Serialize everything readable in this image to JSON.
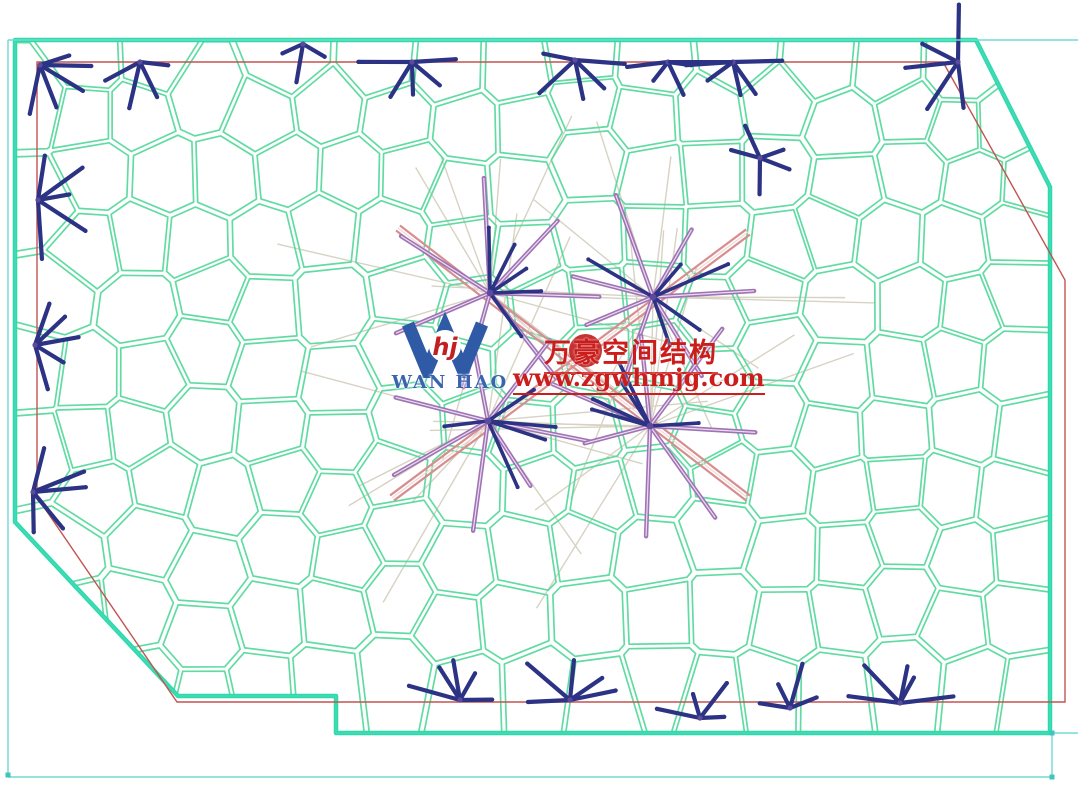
{
  "watermark": {
    "company_cn": "万豪空间结构",
    "url": "www.zgwhmjg.com",
    "logo_text": "WAN HAO",
    "logo_monogram": "hj"
  },
  "diagram": {
    "colors": {
      "background": "#ffffff",
      "mesh_line": "#55d89b",
      "border_green": "#2bdda3",
      "border_teal": "#46d6c4",
      "red": "#c25450",
      "cyan": "#73d8d2",
      "cyan_dot": "#3fc4be",
      "navy": "#2c3384",
      "node_purple": "#5d4a9c",
      "purple": "#a073b4",
      "purple_core": "#eadcf2",
      "pink": "#d88e8e",
      "pink_core": "#f2d8d8",
      "beige": "#d7d2c3",
      "logo_blue": "#2f5ba6",
      "logo_text_blue": "#3a64b0",
      "red_text": "#cc1d1d",
      "seal_red": "#c22020"
    },
    "outline": [
      [
        15,
        40
      ],
      [
        976,
        40
      ],
      [
        1050,
        187
      ],
      [
        1050,
        733
      ],
      [
        336,
        733
      ],
      [
        336,
        696
      ],
      [
        178,
        696
      ],
      [
        15,
        522
      ]
    ],
    "red_outline": [
      [
        37,
        62
      ],
      [
        943,
        62
      ],
      [
        1065,
        280
      ],
      [
        1065,
        702
      ],
      [
        177,
        702
      ],
      [
        37,
        497
      ]
    ],
    "cyan_segments": [
      [
        8,
        40,
        1078,
        40
      ],
      [
        8,
        40,
        8,
        775
      ],
      [
        8,
        777,
        1052,
        777
      ],
      [
        1052,
        733,
        1052,
        777
      ],
      [
        1050,
        733,
        1078,
        733
      ]
    ],
    "cyan_dots": [
      [
        8,
        775
      ],
      [
        1052,
        777
      ],
      [
        1052,
        733
      ]
    ],
    "mesh": {
      "seed": 7,
      "clip": [
        [
          12,
          38
        ],
        [
          978,
          38
        ],
        [
          1052,
          188
        ],
        [
          1052,
          736
        ],
        [
          12,
          736
        ]
      ],
      "x0": 20,
      "x1": 1055,
      "y0": 48,
      "y1": 740,
      "step": 63,
      "jitter": 20,
      "lloyd": 2,
      "inset": 0.93,
      "strokeW": 1.7
    },
    "stars": [
      [
        40,
        65,
        5,
        -25,
        105,
        28,
        55
      ],
      [
        140,
        62,
        4,
        15,
        165,
        25,
        48
      ],
      [
        303,
        44,
        3,
        30,
        150,
        22,
        40
      ],
      [
        412,
        62,
        5,
        5,
        175,
        28,
        55
      ],
      [
        575,
        60,
        5,
        0,
        180,
        30,
        60
      ],
      [
        668,
        62,
        4,
        15,
        165,
        22,
        42
      ],
      [
        733,
        62,
        5,
        0,
        180,
        28,
        52
      ],
      [
        958,
        62,
        5,
        78,
        258,
        35,
        62
      ],
      [
        38,
        200,
        5,
        -78,
        78,
        30,
        60
      ],
      [
        35,
        345,
        5,
        -78,
        78,
        30,
        60
      ],
      [
        33,
        492,
        5,
        -70,
        80,
        28,
        55
      ],
      [
        460,
        700,
        5,
        188,
        352,
        30,
        55
      ],
      [
        570,
        700,
        5,
        185,
        355,
        30,
        58
      ],
      [
        700,
        718,
        4,
        192,
        348,
        24,
        45
      ],
      [
        790,
        708,
        4,
        190,
        350,
        25,
        50
      ],
      [
        900,
        703,
        5,
        186,
        354,
        28,
        55
      ],
      [
        760,
        158,
        5,
        0,
        360,
        22,
        42
      ]
    ],
    "navy_chords": [
      [
        670,
        62,
        731,
        62
      ]
    ],
    "hubs": [
      [
        490,
        293
      ],
      [
        653,
        297
      ],
      [
        488,
        421
      ],
      [
        650,
        426
      ]
    ],
    "hub_style": {
      "beige_n": 11,
      "purple_n": 7,
      "navy_n": 5
    },
    "pink_bands": [
      [
        398,
        228,
        748,
        498
      ],
      [
        748,
        232,
        392,
        498
      ]
    ]
  }
}
